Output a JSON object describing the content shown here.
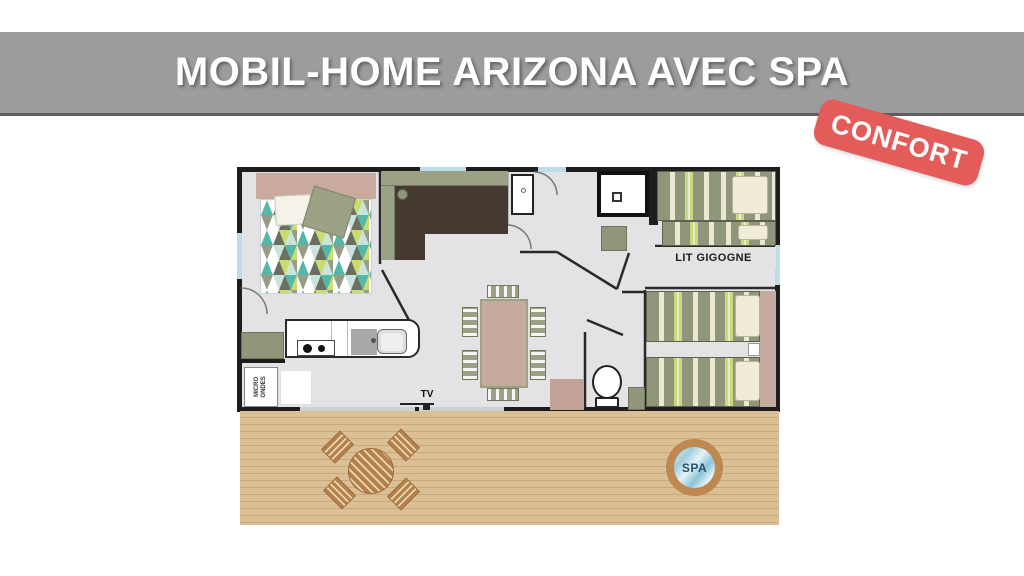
{
  "title": {
    "text": "MOBIL-HOME ARIZONA AVEC SPA"
  },
  "badge": {
    "text": "CONFORT"
  },
  "plan": {
    "labels": {
      "lit_gigogne": "LIT GIGOGNE",
      "tv": "TV",
      "micro_ondes": "MICRO ONDES"
    },
    "furniture_icons": [
      "double-bed",
      "corner-sofa",
      "kitchen-counter",
      "stove",
      "sink",
      "microwave",
      "washbasin",
      "shower",
      "wardrobe",
      "dining-table",
      "chairs",
      "toilet",
      "single-bed",
      "gigogne-bed",
      "twin-beds",
      "nightstand",
      "tv-stand"
    ]
  },
  "deck": {
    "spa_label": "SPA",
    "icons": [
      "wood-deck",
      "round-table",
      "deck-chairs",
      "spa-hot-tub"
    ]
  },
  "colors": {
    "header_gray": "#9c9c9e",
    "header_border": "#5e5e60",
    "badge_red": "#e45c59",
    "wall_black": "#1d1d1d",
    "floor_gray": "#e3e3e5",
    "sage": "#9aa184",
    "sage_dark": "#8f9679",
    "sofa_dark": "#453931",
    "headboard_tan": "#c9aa9d",
    "table_rose": "#c6aa9d",
    "deck_wood": "#dcc095",
    "deck_line": "#c8a97b",
    "wood_brown": "#b5814b",
    "wood_hatch": "#ead7b4",
    "water_blue": "#aed7e4",
    "spa_text": "#27516e",
    "window_blue": "#bfdde8",
    "cream": "#f0ecd8",
    "stripe_cream": "#ece7d0",
    "stripe_lime": "#c9d97c",
    "blanket_teal": "#53b8a7",
    "blanket_pale": "#c8e4dc",
    "blanket_dark": "#6a7060",
    "blanket_gray": "#969c86",
    "blanket_lime": "#cadc6e"
  }
}
